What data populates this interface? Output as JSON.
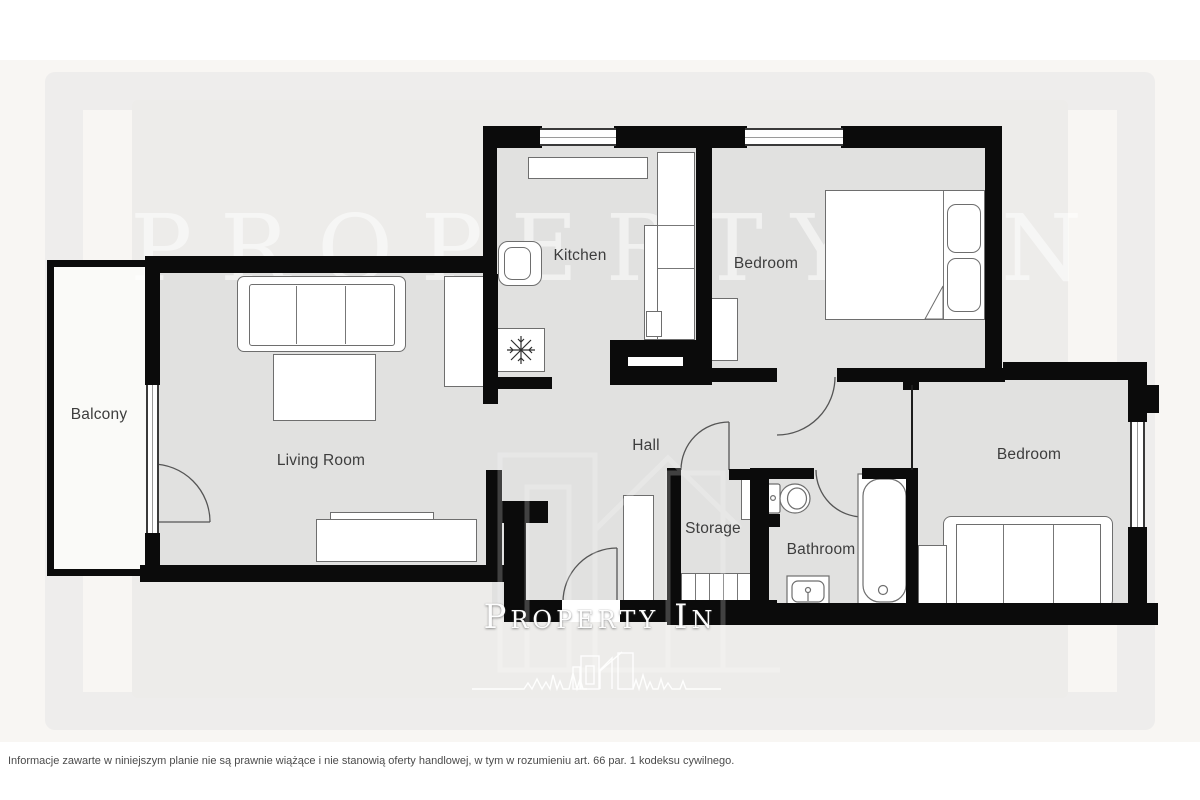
{
  "rooms": [
    {
      "id": "balcony",
      "label": "Balcony"
    },
    {
      "id": "living-room",
      "label": "Living Room"
    },
    {
      "id": "kitchen",
      "label": "Kitchen"
    },
    {
      "id": "bedroom-1",
      "label": "Bedroom"
    },
    {
      "id": "hall",
      "label": "Hall"
    },
    {
      "id": "storage",
      "label": "Storage"
    },
    {
      "id": "bathroom",
      "label": "Bathroom"
    },
    {
      "id": "bedroom-2",
      "label": "Bedroom"
    }
  ],
  "watermarks": {
    "header_text": "PROPERTY IN",
    "footer_text": "Property In"
  },
  "footer": {
    "disclaimer": "Informacje zawarte w niniejszym planie nie są prawnie wiążące i nie stanowią oferty handlowej, w tym w rozumieniu art. 66 par. 1 kodeksu cywilnego."
  },
  "icons": [
    {
      "name": "snowflake-icon",
      "meaning": "fridge/freezer symbol"
    },
    {
      "name": "skyline-heartbeat-logo",
      "meaning": "Property In brand logo"
    }
  ],
  "colors": {
    "wall": "#0b0b0b",
    "room_floor": "#e1e1e0",
    "balcony_floor": "#fafaf8",
    "page_background": "#ffffff",
    "mat_background": "#f8f6f3",
    "panel_background": "#edecea",
    "furniture_outline": "#6e6e6e",
    "label_text": "#3d3d3d",
    "watermark": "#ffffff"
  }
}
